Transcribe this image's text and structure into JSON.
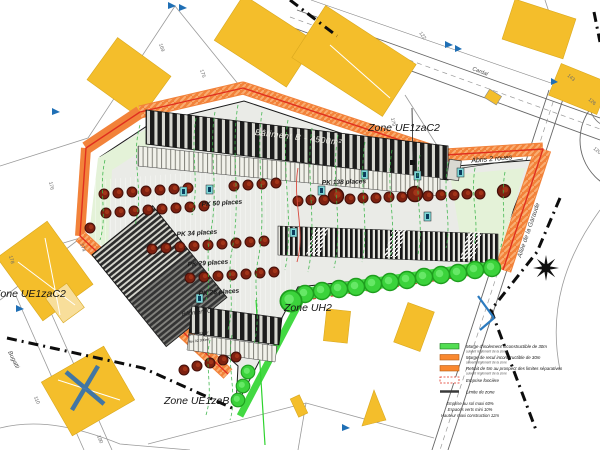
{
  "map": {
    "zones": {
      "top_right": "Zone UE1zaC2",
      "left": "Zone UE1zaC2",
      "south": "Zone UH2",
      "bottom": "Zone UE1zaB"
    },
    "streets": {
      "north_road": "Cardal",
      "east_road": "Allée de la Garaude",
      "west_road": "Bugatti"
    },
    "buildings": {
      "building_b": "Bâtiment B - 4500m²",
      "building_c": "Bâtiment C",
      "building_c_line1": "Niv 01 300m²",
      "building_c_line2": "Niv 02 300m²",
      "shelter": "Abris 2 roues"
    },
    "parking_labels": [
      "PK 50 places",
      "PK 34 places",
      "PK 29 places",
      "PK 26 places",
      "PK 138 places"
    ],
    "parcel_numbers": [
      "169",
      "175",
      "122",
      "179",
      "143",
      "126",
      "120",
      "176",
      "178",
      "174",
      "110",
      "190"
    ]
  },
  "legend": {
    "items": [
      {
        "label": "Marge d'isolement inconstructible de 30m",
        "sub": "suivant règlement de la zone",
        "color": "#52DD52"
      },
      {
        "label": "Marge de recul inconstructible de 30m",
        "sub": "suivant règlement de la zone",
        "color": "#F9882F"
      },
      {
        "label": "Retrait de 5m au prospect des limites séparatives",
        "sub": "suivant règlement de la zone",
        "color": "#F9882F"
      },
      {
        "label": "Emprise foncière",
        "color": "#FFFFFF"
      },
      {
        "label": "Limite de zone",
        "color": "#3A3A3A"
      }
    ],
    "notes": [
      "Emprise au sol maxi 60%",
      "Espaces verts mini 10%",
      "Hauteur maxi construction 12m"
    ]
  },
  "colors": {
    "existing_building": "#F4BE2B",
    "site_fill": "#EAEBE7",
    "margin_orange": "#F2823A",
    "margin_green": "#42D942",
    "boundary_red": "#E02F1F",
    "contour_green": "#3CB54A"
  }
}
